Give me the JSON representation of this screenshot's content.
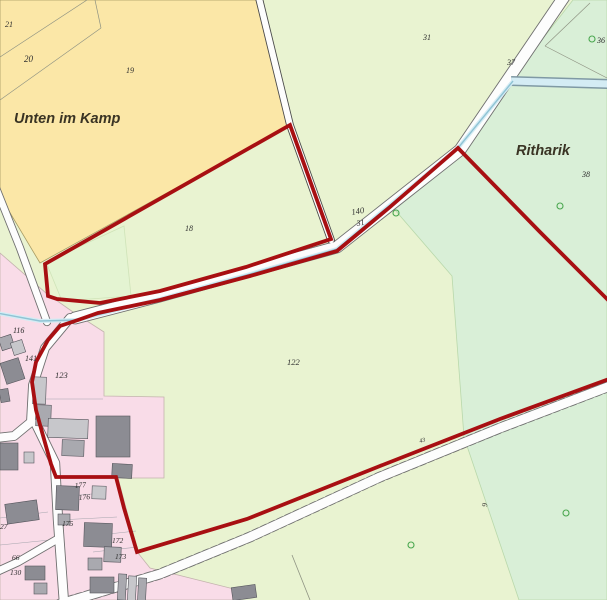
{
  "map": {
    "width": 607,
    "height": 600,
    "colors": {
      "base": "#e9f3d1",
      "mint": "#d9efd7",
      "mint_stroke": "#b9d8ab",
      "yellow": "#fbe7a7",
      "yellow_stroke": "#a79b63",
      "p18": "#e4f4d2",
      "p18_stroke": "#cfe3b8",
      "pink": "#f9dce8",
      "pink_stroke": "#c3b3ad",
      "road_fill": "#fdfdfd",
      "road_casing": "#6f6f6f",
      "road_casing_dark": "#4a4a4a",
      "stream_light": "#d4ecf4",
      "stream_dark": "#8fc3d4",
      "stream_band_edge": "#7f99a4",
      "red": "#a80f12",
      "bldg_light": "#c7c7cb",
      "bldg_mid": "#a9a9af",
      "bldg_dark": "#8c8c93",
      "bldg_stroke": "#55555c",
      "line": "#8f9383",
      "line_pink": "#a5a5ad",
      "tree": "#4aa74f",
      "label_num": "#2e2e2e",
      "label_place": "#3a3424"
    },
    "regions": [
      {
        "name": "region-base-green",
        "fill": "base",
        "stroke": "",
        "pts": [
          [
            0,
            0
          ],
          [
            607,
            0
          ],
          [
            607,
            600
          ],
          [
            0,
            600
          ]
        ]
      },
      {
        "name": "region-mint-east",
        "fill": "mint",
        "stroke": "mint_stroke",
        "pts": [
          [
            573,
            0
          ],
          [
            607,
            0
          ],
          [
            607,
            600
          ],
          [
            519,
            600
          ],
          [
            464,
            437
          ],
          [
            452,
            276
          ],
          [
            389,
            203
          ],
          [
            458,
            147
          ]
        ]
      },
      {
        "name": "region-yellow-unten-im-kamp",
        "fill": "yellow",
        "stroke": "yellow_stroke",
        "pts": [
          [
            0,
            0
          ],
          [
            256,
            0
          ],
          [
            290,
            125
          ],
          [
            40,
            263
          ],
          [
            0,
            196
          ]
        ]
      },
      {
        "name": "region-parcel-18-tint",
        "fill": "p18",
        "stroke": "p18_stroke",
        "pts": [
          [
            46,
            262
          ],
          [
            124,
            226
          ],
          [
            131,
            296
          ],
          [
            62,
            301
          ]
        ]
      },
      {
        "name": "region-pink-residential",
        "fill": "pink",
        "stroke": "pink_stroke",
        "pts": [
          [
            0,
            253
          ],
          [
            46,
            293
          ],
          [
            73,
            312
          ],
          [
            104,
            332
          ],
          [
            104,
            396
          ],
          [
            164,
            397
          ],
          [
            164,
            478
          ],
          [
            118,
            478
          ],
          [
            138,
            553
          ],
          [
            150,
            568
          ],
          [
            238,
            590
          ],
          [
            238,
            600
          ],
          [
            0,
            600
          ]
        ]
      }
    ],
    "boundaries": [
      {
        "name": "parcel-line",
        "stroke": "line",
        "w": 0.7,
        "pts": [
          [
            87,
            0
          ],
          [
            0,
            57
          ]
        ]
      },
      {
        "name": "parcel-line",
        "stroke": "line",
        "w": 0.7,
        "pts": [
          [
            95,
            0
          ],
          [
            101,
            28
          ]
        ]
      },
      {
        "name": "parcel-line",
        "stroke": "line",
        "w": 0.7,
        "pts": [
          [
            101,
            28
          ],
          [
            0,
            100
          ]
        ]
      },
      {
        "name": "parcel-line",
        "stroke": "line",
        "w": 0.7,
        "pts": [
          [
            545,
            46
          ],
          [
            590,
            3
          ]
        ]
      },
      {
        "name": "parcel-line",
        "stroke": "line",
        "w": 0.7,
        "pts": [
          [
            545,
            46
          ],
          [
            607,
            78
          ]
        ]
      },
      {
        "name": "parcel-line",
        "stroke": "line",
        "w": 0.8,
        "pts": [
          [
            292,
            555
          ],
          [
            310,
            600
          ]
        ]
      },
      {
        "name": "parcel-line",
        "stroke": "line_pink",
        "w": 0.6,
        "pts": [
          [
            33,
            399
          ],
          [
            103,
            399
          ]
        ]
      },
      {
        "name": "parcel-line",
        "stroke": "line_pink",
        "w": 0.6,
        "pts": [
          [
            58,
            520
          ],
          [
            117,
            517
          ]
        ]
      },
      {
        "name": "parcel-line",
        "stroke": "line_pink",
        "w": 0.6,
        "pts": [
          [
            90,
            536
          ],
          [
            136,
            531
          ]
        ]
      },
      {
        "name": "parcel-line",
        "stroke": "line_pink",
        "w": 0.6,
        "pts": [
          [
            93,
            552
          ],
          [
            138,
            547
          ]
        ]
      },
      {
        "name": "parcel-line",
        "stroke": "line_pink",
        "w": 0.6,
        "pts": [
          [
            0,
            518
          ],
          [
            48,
            512
          ]
        ]
      },
      {
        "name": "parcel-line",
        "stroke": "line_pink",
        "w": 0.6,
        "pts": [
          [
            0,
            545
          ],
          [
            50,
            540
          ]
        ]
      },
      {
        "name": "parcel-line",
        "stroke": "line_pink",
        "w": 0.6,
        "pts": [
          [
            56,
            497
          ],
          [
            92,
            494
          ]
        ]
      }
    ],
    "roads": [
      {
        "name": "road-main-northeast",
        "w": 11,
        "dashed": false,
        "dark": false,
        "pts": [
          [
            566,
            -6
          ],
          [
            460,
            150
          ],
          [
            337,
            247
          ],
          [
            250,
            271
          ],
          [
            160,
            296
          ],
          [
            75,
            318
          ]
        ]
      },
      {
        "name": "road-upper-left",
        "w": 6,
        "dashed": false,
        "dark": true,
        "pts": [
          [
            258,
            -6
          ],
          [
            290,
            125
          ],
          [
            331,
            240
          ]
        ]
      },
      {
        "name": "road-west",
        "w": 6.5,
        "dashed": false,
        "dark": false,
        "pts": [
          [
            -4,
            188
          ],
          [
            20,
            248
          ],
          [
            47,
            322
          ]
        ]
      },
      {
        "name": "road-street-north",
        "w": 8,
        "dashed": false,
        "dark": false,
        "pts": [
          [
            70,
            318
          ],
          [
            45,
            348
          ],
          [
            33,
            385
          ],
          [
            31,
            422
          ],
          [
            14,
            436
          ],
          [
            -4,
            438
          ]
        ]
      },
      {
        "name": "road-street-south",
        "w": 8.5,
        "dashed": false,
        "dark": false,
        "pts": [
          [
            36,
            424
          ],
          [
            55,
            463
          ],
          [
            58,
            520
          ],
          [
            64,
            603
          ]
        ]
      },
      {
        "name": "road-southwest-branch",
        "w": 7,
        "dashed": false,
        "dark": false,
        "pts": [
          [
            56,
            540
          ],
          [
            18,
            562
          ],
          [
            -4,
            572
          ]
        ]
      },
      {
        "name": "road-bottom-diagonal",
        "w": 9,
        "dashed": true,
        "dark": false,
        "pts": [
          [
            60,
            604
          ],
          [
            160,
            574
          ],
          [
            250,
            537
          ],
          [
            380,
            477
          ],
          [
            500,
            428
          ],
          [
            610,
            386
          ]
        ]
      }
    ],
    "stream": {
      "band": {
        "name": "stream-band",
        "pts": [
          [
            609,
            84
          ],
          [
            511,
            81
          ]
        ],
        "edge_w": 10,
        "fill_w": 7
      },
      "line": {
        "name": "stream-line",
        "pts": [
          [
            513,
            81
          ],
          [
            458,
            148
          ],
          [
            390,
            205
          ],
          [
            337,
            249
          ],
          [
            250,
            274
          ],
          [
            160,
            299
          ],
          [
            78,
            320
          ],
          [
            40,
            321
          ],
          [
            -3,
            313
          ]
        ],
        "glow_w": 4,
        "core_w": 1.4
      }
    },
    "red_boundary": {
      "closed": [
        [
          45,
          264
        ],
        [
          290,
          125
        ],
        [
          331,
          239
        ],
        [
          246,
          267
        ],
        [
          160,
          291
        ],
        [
          100,
          303
        ],
        [
          57,
          299
        ],
        [
          48,
          296
        ]
      ],
      "open": [
        [
          609,
          301
        ],
        [
          540,
          232
        ],
        [
          458,
          148
        ],
        [
          390,
          207
        ],
        [
          337,
          251
        ],
        [
          250,
          276
        ],
        [
          160,
          300
        ],
        [
          98,
          313
        ],
        [
          78,
          320
        ],
        [
          60,
          326
        ],
        [
          48,
          340
        ],
        [
          36,
          362
        ],
        [
          32,
          382
        ],
        [
          36,
          410
        ],
        [
          42,
          432
        ],
        [
          51,
          464
        ],
        [
          56,
          477
        ],
        [
          116,
          477
        ],
        [
          124,
          508
        ],
        [
          137,
          552
        ],
        [
          247,
          519
        ],
        [
          380,
          466
        ],
        [
          500,
          419
        ],
        [
          609,
          379
        ]
      ],
      "w": 3.8
    },
    "buildings": [
      [
        0,
        336,
        13,
        13,
        -18,
        "mid"
      ],
      [
        12,
        341,
        12,
        13,
        -18,
        "light"
      ],
      [
        3,
        360,
        19,
        22,
        -18,
        "dark"
      ],
      [
        0,
        389,
        9,
        13,
        -10,
        "dark"
      ],
      [
        33,
        377,
        13,
        27,
        2,
        "light"
      ],
      [
        36,
        405,
        15,
        21,
        2,
        "mid"
      ],
      [
        48,
        419,
        40,
        19,
        2,
        "light"
      ],
      [
        96,
        416,
        34,
        41,
        0,
        "dark"
      ],
      [
        62,
        440,
        22,
        16,
        2,
        "mid"
      ],
      [
        112,
        464,
        20,
        14,
        3,
        "dark"
      ],
      [
        56,
        486,
        23,
        24,
        2,
        "dark"
      ],
      [
        92,
        486,
        14,
        13,
        2,
        "light"
      ],
      [
        6,
        502,
        32,
        20,
        -8,
        "dark"
      ],
      [
        24,
        452,
        10,
        11,
        0,
        "light"
      ],
      [
        0,
        443,
        18,
        27,
        0,
        "dark"
      ],
      [
        58,
        514,
        12,
        11,
        0,
        "mid"
      ],
      [
        84,
        523,
        28,
        24,
        2,
        "dark"
      ],
      [
        104,
        547,
        17,
        15,
        2,
        "mid"
      ],
      [
        25,
        566,
        20,
        14,
        0,
        "dark"
      ],
      [
        34,
        583,
        13,
        11,
        0,
        "mid"
      ],
      [
        88,
        558,
        14,
        12,
        0,
        "mid"
      ],
      [
        90,
        577,
        24,
        16,
        0,
        "dark"
      ],
      [
        118,
        574,
        8,
        26,
        3,
        "mid"
      ],
      [
        128,
        576,
        8,
        26,
        3,
        "light"
      ],
      [
        138,
        578,
        8,
        26,
        3,
        "mid"
      ],
      [
        232,
        586,
        24,
        13,
        -8,
        "dark"
      ]
    ],
    "trees": [
      [
        592,
        39
      ],
      [
        560,
        206
      ],
      [
        396,
        213
      ],
      [
        566,
        513
      ],
      [
        411,
        545
      ]
    ],
    "labels": [
      {
        "text": "21",
        "x": 5,
        "y": 27,
        "fs": 8,
        "kind": "num",
        "rot": 0
      },
      {
        "text": "20",
        "x": 24,
        "y": 62,
        "fs": 9,
        "kind": "num",
        "rot": 0
      },
      {
        "text": "19",
        "x": 126,
        "y": 73,
        "fs": 8,
        "kind": "num",
        "rot": 0
      },
      {
        "text": "Unten im Kamp",
        "x": 14,
        "y": 123,
        "fs": 14.5,
        "kind": "place",
        "rot": 0
      },
      {
        "text": "31",
        "x": 423,
        "y": 40,
        "fs": 8,
        "kind": "num",
        "rot": 0
      },
      {
        "text": "37",
        "x": 507,
        "y": 65,
        "fs": 8,
        "kind": "num",
        "rot": 0
      },
      {
        "text": "36",
        "x": 597,
        "y": 43,
        "fs": 8,
        "kind": "num",
        "rot": 0
      },
      {
        "text": "Ritharik",
        "x": 516,
        "y": 155,
        "fs": 14.5,
        "kind": "place",
        "rot": 0
      },
      {
        "text": "38",
        "x": 582,
        "y": 177,
        "fs": 8,
        "kind": "num",
        "rot": 0
      },
      {
        "text": "140",
        "x": 352,
        "y": 215,
        "fs": 8.5,
        "kind": "num",
        "rot": -10
      },
      {
        "text": "31",
        "x": 357,
        "y": 226,
        "fs": 8,
        "kind": "num",
        "rot": -10
      },
      {
        "text": "18",
        "x": 185,
        "y": 231,
        "fs": 8,
        "kind": "num",
        "rot": 0
      },
      {
        "text": "122",
        "x": 287,
        "y": 365,
        "fs": 8.5,
        "kind": "num",
        "rot": 0
      },
      {
        "text": "116",
        "x": 13,
        "y": 333,
        "fs": 8,
        "kind": "num",
        "rot": 0
      },
      {
        "text": "141",
        "x": 25,
        "y": 361,
        "fs": 8,
        "kind": "num",
        "rot": 0
      },
      {
        "text": "123",
        "x": 55,
        "y": 378,
        "fs": 8.5,
        "kind": "num",
        "rot": 0
      },
      {
        "text": "177",
        "x": 75,
        "y": 488,
        "fs": 7.5,
        "kind": "num",
        "rot": -5
      },
      {
        "text": "176",
        "x": 79,
        "y": 500,
        "fs": 7.5,
        "kind": "num",
        "rot": -5
      },
      {
        "text": "175",
        "x": 62,
        "y": 526,
        "fs": 7.5,
        "kind": "num",
        "rot": 0
      },
      {
        "text": "172",
        "x": 112,
        "y": 543,
        "fs": 7.5,
        "kind": "num",
        "rot": 0
      },
      {
        "text": "173",
        "x": 115,
        "y": 559,
        "fs": 7.5,
        "kind": "num",
        "rot": 0
      },
      {
        "text": "130",
        "x": 10,
        "y": 575,
        "fs": 7.5,
        "kind": "num",
        "rot": 0
      },
      {
        "text": "27",
        "x": 0,
        "y": 529,
        "fs": 7.5,
        "kind": "num",
        "rot": 0
      },
      {
        "text": "66",
        "x": 12,
        "y": 560,
        "fs": 7.5,
        "kind": "num",
        "rot": 0
      },
      {
        "text": "43",
        "x": 420,
        "y": 443,
        "fs": 6,
        "kind": "num",
        "rot": -18
      },
      {
        "text": "9",
        "x": 487,
        "y": 507,
        "fs": 7.5,
        "kind": "num",
        "rot": -85
      }
    ]
  }
}
